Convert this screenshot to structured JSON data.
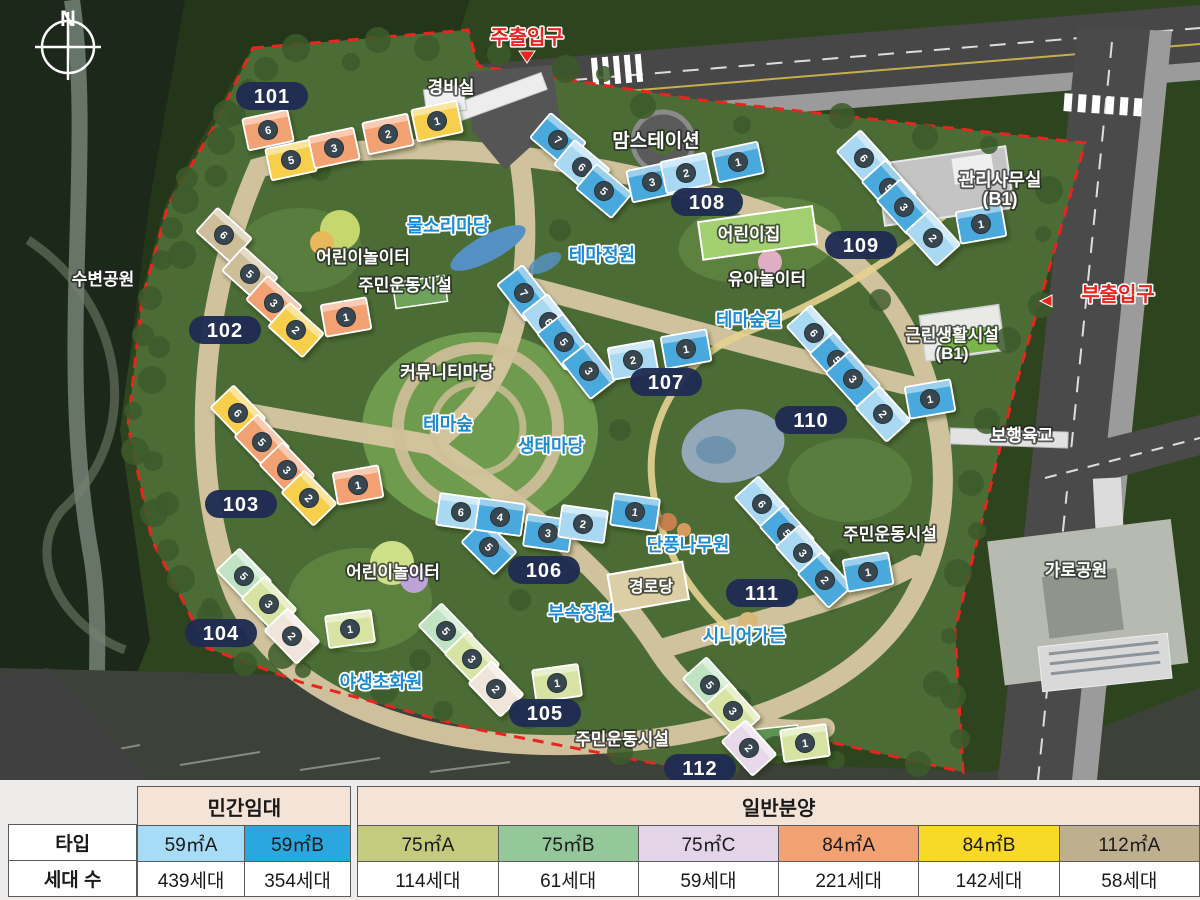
{
  "map": {
    "compass_label": "N",
    "entrances": {
      "main": {
        "label": "주출입구",
        "x": 527,
        "y": 44,
        "arrow": "down"
      },
      "sub": {
        "label": "부출입구",
        "x": 1118,
        "y": 301,
        "arrow": "left"
      }
    },
    "badges": [
      {
        "num": "101",
        "x": 272,
        "y": 96
      },
      {
        "num": "102",
        "x": 225,
        "y": 330
      },
      {
        "num": "103",
        "x": 241,
        "y": 504
      },
      {
        "num": "104",
        "x": 221,
        "y": 633
      },
      {
        "num": "105",
        "x": 545,
        "y": 713
      },
      {
        "num": "106",
        "x": 544,
        "y": 570
      },
      {
        "num": "107",
        "x": 666,
        "y": 382
      },
      {
        "num": "108",
        "x": 707,
        "y": 202
      },
      {
        "num": "109",
        "x": 861,
        "y": 245
      },
      {
        "num": "110",
        "x": 811,
        "y": 420
      },
      {
        "num": "111",
        "x": 762,
        "y": 593
      },
      {
        "num": "112",
        "x": 700,
        "y": 768
      }
    ],
    "labels": [
      {
        "text": "경비실",
        "x": 451,
        "y": 93,
        "style": "white",
        "size": 17
      },
      {
        "text": "맘스테이션",
        "x": 656,
        "y": 147,
        "style": "white",
        "size": 19
      },
      {
        "text": "관리사무실",
        "x": 1000,
        "y": 186,
        "style": "white",
        "size": 18
      },
      {
        "text": "(B1)",
        "x": 1000,
        "y": 205,
        "style": "white",
        "size": 18
      },
      {
        "text": "물소리마당",
        "x": 448,
        "y": 232,
        "style": "blue",
        "size": 18
      },
      {
        "text": "어린이놀이터",
        "x": 363,
        "y": 263,
        "style": "white",
        "size": 17
      },
      {
        "text": "주민운동시설",
        "x": 405,
        "y": 291,
        "style": "white",
        "size": 17
      },
      {
        "text": "테마정원",
        "x": 602,
        "y": 261,
        "style": "blue",
        "size": 18
      },
      {
        "text": "어린이집",
        "x": 749,
        "y": 240,
        "style": "white",
        "size": 17
      },
      {
        "text": "유아놀이터",
        "x": 767,
        "y": 285,
        "style": "white",
        "size": 17
      },
      {
        "text": "테마숲길",
        "x": 749,
        "y": 326,
        "style": "blue",
        "size": 18
      },
      {
        "text": "근린생활시설",
        "x": 952,
        "y": 341,
        "style": "white",
        "size": 17
      },
      {
        "text": "(B1)",
        "x": 952,
        "y": 359,
        "style": "white",
        "size": 17
      },
      {
        "text": "수변공원",
        "x": 103,
        "y": 285,
        "style": "white",
        "size": 17
      },
      {
        "text": "커뮤니티마당",
        "x": 447,
        "y": 378,
        "style": "white",
        "size": 17
      },
      {
        "text": "테마숲",
        "x": 448,
        "y": 430,
        "style": "blue",
        "size": 18
      },
      {
        "text": "생태마당",
        "x": 551,
        "y": 452,
        "style": "blue",
        "size": 18
      },
      {
        "text": "보행육교",
        "x": 1022,
        "y": 441,
        "style": "white",
        "size": 17
      },
      {
        "text": "가로공원",
        "x": 1076,
        "y": 576,
        "style": "white",
        "size": 17
      },
      {
        "text": "단풍나무원",
        "x": 688,
        "y": 551,
        "style": "blue",
        "size": 18
      },
      {
        "text": "경로당",
        "x": 651,
        "y": 592,
        "style": "white",
        "size": 16
      },
      {
        "text": "부속정원",
        "x": 581,
        "y": 619,
        "style": "blue",
        "size": 18
      },
      {
        "text": "시니어가든",
        "x": 744,
        "y": 642,
        "style": "blue",
        "size": 18
      },
      {
        "text": "어린이놀이터",
        "x": 393,
        "y": 578,
        "style": "white",
        "size": 17
      },
      {
        "text": "야생초화원",
        "x": 381,
        "y": 688,
        "style": "blue",
        "size": 18
      },
      {
        "text": "주민운동시설",
        "x": 890,
        "y": 540,
        "style": "white",
        "size": 17
      },
      {
        "text": "주민운동시설",
        "x": 622,
        "y": 745,
        "style": "white",
        "size": 17
      }
    ],
    "unit_colors": {
      "s": "#f2a173",
      "y": "#f7cf4e",
      "t": "#cdbd98",
      "m": "#bfe3c3",
      "g": "#d7e3a3",
      "c": "#efe5da",
      "l": "#e7d9ea",
      "b": "#4aa8dc",
      "lb": "#a9d9f2"
    },
    "buildings": [
      {
        "id": "101",
        "units": [
          [
            268,
            130,
            -12,
            "s",
            "6"
          ],
          [
            291,
            160,
            -12,
            "y",
            "5"
          ],
          [
            334,
            148,
            -12,
            "s",
            "3"
          ],
          [
            388,
            134,
            -12,
            "s",
            "2"
          ],
          [
            437,
            121,
            -12,
            "y",
            "1"
          ]
        ]
      },
      {
        "id": "102",
        "units": [
          [
            224,
            235,
            42,
            "t",
            "6"
          ],
          [
            250,
            274,
            42,
            "t",
            "5"
          ],
          [
            274,
            303,
            42,
            "s",
            "3"
          ],
          [
            296,
            330,
            42,
            "y",
            "2"
          ],
          [
            346,
            317,
            -10,
            "s",
            "1"
          ]
        ]
      },
      {
        "id": "103",
        "units": [
          [
            238,
            413,
            46,
            "y",
            "6"
          ],
          [
            262,
            442,
            46,
            "s",
            "5"
          ],
          [
            287,
            470,
            46,
            "s",
            "3"
          ],
          [
            309,
            498,
            46,
            "y",
            "2"
          ],
          [
            358,
            485,
            -10,
            "s",
            "1"
          ]
        ]
      },
      {
        "id": "104",
        "units": [
          [
            244,
            576,
            46,
            "m",
            "5"
          ],
          [
            269,
            604,
            46,
            "g",
            "3"
          ],
          [
            292,
            636,
            46,
            "c",
            "2"
          ],
          [
            350,
            629,
            -8,
            "g",
            "1"
          ]
        ]
      },
      {
        "id": "105",
        "units": [
          [
            446,
            631,
            46,
            "m",
            "5"
          ],
          [
            472,
            659,
            46,
            "g",
            "3"
          ],
          [
            496,
            689,
            46,
            "c",
            "2"
          ],
          [
            557,
            683,
            -8,
            "g",
            "1"
          ]
        ]
      },
      {
        "id": "106",
        "units": [
          [
            461,
            512,
            8,
            "lb",
            "6"
          ],
          [
            489,
            547,
            45,
            "b",
            "5"
          ],
          [
            500,
            517,
            8,
            "b",
            "4"
          ],
          [
            548,
            533,
            8,
            "b",
            "3"
          ],
          [
            583,
            524,
            8,
            "lb",
            "2"
          ],
          [
            635,
            512,
            8,
            "b",
            "1"
          ]
        ]
      },
      {
        "id": "107",
        "units": [
          [
            524,
            293,
            52,
            "b",
            "7"
          ],
          [
            549,
            322,
            52,
            "lb",
            "6"
          ],
          [
            564,
            342,
            52,
            "b",
            "5"
          ],
          [
            589,
            371,
            52,
            "b",
            "3"
          ],
          [
            633,
            360,
            -10,
            "lb",
            "2"
          ],
          [
            686,
            349,
            -10,
            "b",
            "1"
          ]
        ]
      },
      {
        "id": "108",
        "units": [
          [
            558,
            140,
            40,
            "b",
            "7"
          ],
          [
            582,
            167,
            40,
            "lb",
            "6"
          ],
          [
            604,
            191,
            40,
            "b",
            "5"
          ],
          [
            652,
            182,
            -12,
            "b",
            "3"
          ],
          [
            686,
            173,
            -12,
            "lb",
            "2"
          ],
          [
            738,
            162,
            -12,
            "b",
            "1"
          ]
        ]
      },
      {
        "id": "109",
        "units": [
          [
            864,
            158,
            48,
            "lb",
            "6"
          ],
          [
            889,
            188,
            48,
            "b",
            "5"
          ],
          [
            904,
            207,
            48,
            "b",
            "3"
          ],
          [
            933,
            238,
            48,
            "lb",
            "2"
          ],
          [
            981,
            224,
            -10,
            "b",
            "1"
          ]
        ]
      },
      {
        "id": "110",
        "units": [
          [
            814,
            333,
            48,
            "lb",
            "6"
          ],
          [
            837,
            360,
            48,
            "b",
            "5"
          ],
          [
            853,
            379,
            48,
            "b",
            "3"
          ],
          [
            883,
            414,
            48,
            "lb",
            "2"
          ],
          [
            930,
            399,
            -10,
            "b",
            "1"
          ]
        ]
      },
      {
        "id": "111",
        "units": [
          [
            762,
            504,
            48,
            "lb",
            "6"
          ],
          [
            787,
            533,
            48,
            "b",
            "5"
          ],
          [
            803,
            553,
            48,
            "lb",
            "3"
          ],
          [
            825,
            580,
            48,
            "b",
            "2"
          ],
          [
            868,
            572,
            -10,
            "b",
            "1"
          ]
        ]
      },
      {
        "id": "112",
        "units": [
          [
            710,
            685,
            48,
            "m",
            "5"
          ],
          [
            733,
            711,
            48,
            "g",
            "3"
          ],
          [
            749,
            748,
            48,
            "l",
            "2"
          ],
          [
            805,
            743,
            -8,
            "g",
            "1"
          ]
        ]
      }
    ]
  },
  "table": {
    "row_headers": {
      "type": "타입",
      "households": "세대 수"
    },
    "groups": [
      {
        "label": "민간임대",
        "columns": [
          {
            "type": "59㎡A",
            "color": "#a6dcf5",
            "households": "439세대"
          },
          {
            "type": "59㎡B",
            "color": "#2ba7e0",
            "households": "354세대"
          }
        ]
      },
      {
        "label": "일반분양",
        "columns": [
          {
            "type": "75㎡A",
            "color": "#c5cb7e",
            "households": "114세대"
          },
          {
            "type": "75㎡B",
            "color": "#94c89b",
            "households": "61세대"
          },
          {
            "type": "75㎡C",
            "color": "#e4d4e8",
            "households": "59세대"
          },
          {
            "type": "84㎡A",
            "color": "#f2a173",
            "households": "221세대"
          },
          {
            "type": "84㎡B",
            "color": "#f8d927",
            "households": "142세대"
          },
          {
            "type": "112㎡A",
            "color": "#beb08e",
            "households": "58세대"
          }
        ]
      }
    ]
  }
}
